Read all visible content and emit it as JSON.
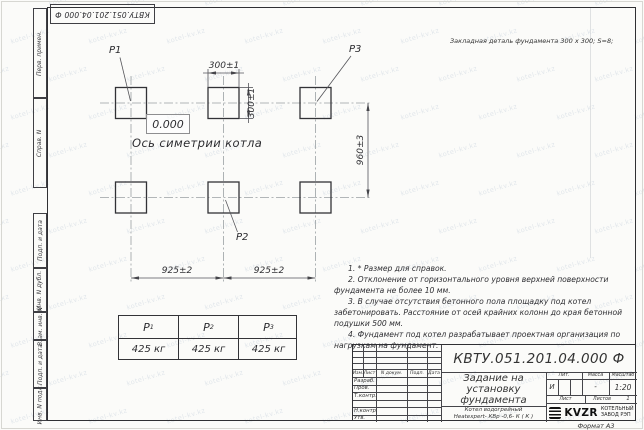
{
  "watermark": {
    "text": "kotel-kv.kz"
  },
  "stamp": {
    "designation_inverted": "КВТУ.051.201.04.000  Ф"
  },
  "header_note": "Закладная деталь фундамента  300 х 300;  S=8;",
  "drawing": {
    "point_labels": {
      "p1": "P1",
      "p2": "P2",
      "p3": "P3"
    },
    "elevation_mark": "0.000",
    "axis_label": "Ось симетрии котла",
    "dimensions": {
      "top_width": "300±1",
      "side_height": "300±1",
      "row_spacing": "960±3",
      "span_left": "925±2",
      "span_right": "925±2"
    }
  },
  "notes": {
    "items": [
      "1. * Размер для справок.",
      "2. Отклонение от горизонтального уровня верхней поверхности фундамента не более 10 мм.",
      "3. В случае отсутствия бетонного пола площадку под котел забетонировать. Расстояние от осей крайних колонн до края бетонной подушки 500 мм.",
      "4. Фундамент под котел разрабатывает проектная организация по нагрузкам на фундамент."
    ]
  },
  "load_table": {
    "columns": [
      {
        "name": "P",
        "sub": "1",
        "value": "425 кг"
      },
      {
        "name": "P",
        "sub": "2",
        "value": "425 кг"
      },
      {
        "name": "P",
        "sub": "3",
        "value": "425 кг"
      }
    ]
  },
  "sidebar": {
    "items": [
      "Перв. примен.",
      "Справ. N",
      "Подп. и дата",
      "Инв. N дубл.",
      "Взам. инв. N",
      "Подп. и дата",
      "Инв. N подл."
    ]
  },
  "title_block": {
    "designation": "КВТУ.051.201.04.000  Ф",
    "title_lines": [
      "Задание на",
      "установку",
      "фундамента"
    ],
    "product_lines": [
      "Котел водогрейный",
      "Heatexpert- КВр -0,6- К ( К )"
    ],
    "header_cells": [
      "Изм.",
      "Лист",
      "N докум.",
      "Подп.",
      "Дата"
    ],
    "row_labels": [
      "Разраб.",
      "Пров.",
      "Т.контр.",
      "",
      "Н.контр.",
      "Утв."
    ],
    "lit_label": "Лит.",
    "lit_value": "И",
    "mass_label": "Масса",
    "mass_value": "-",
    "scale_label": "Масштаб",
    "scale_value": "1:20",
    "sheet_label": "Лист",
    "sheets_label": "Листов",
    "sheets_value": "1",
    "logo_text": "KVZR",
    "logo_caption_lines": [
      "КОТЕЛЬНЫЙ",
      "ЗАВОД РЭП"
    ],
    "format_label": "Формат А3"
  }
}
